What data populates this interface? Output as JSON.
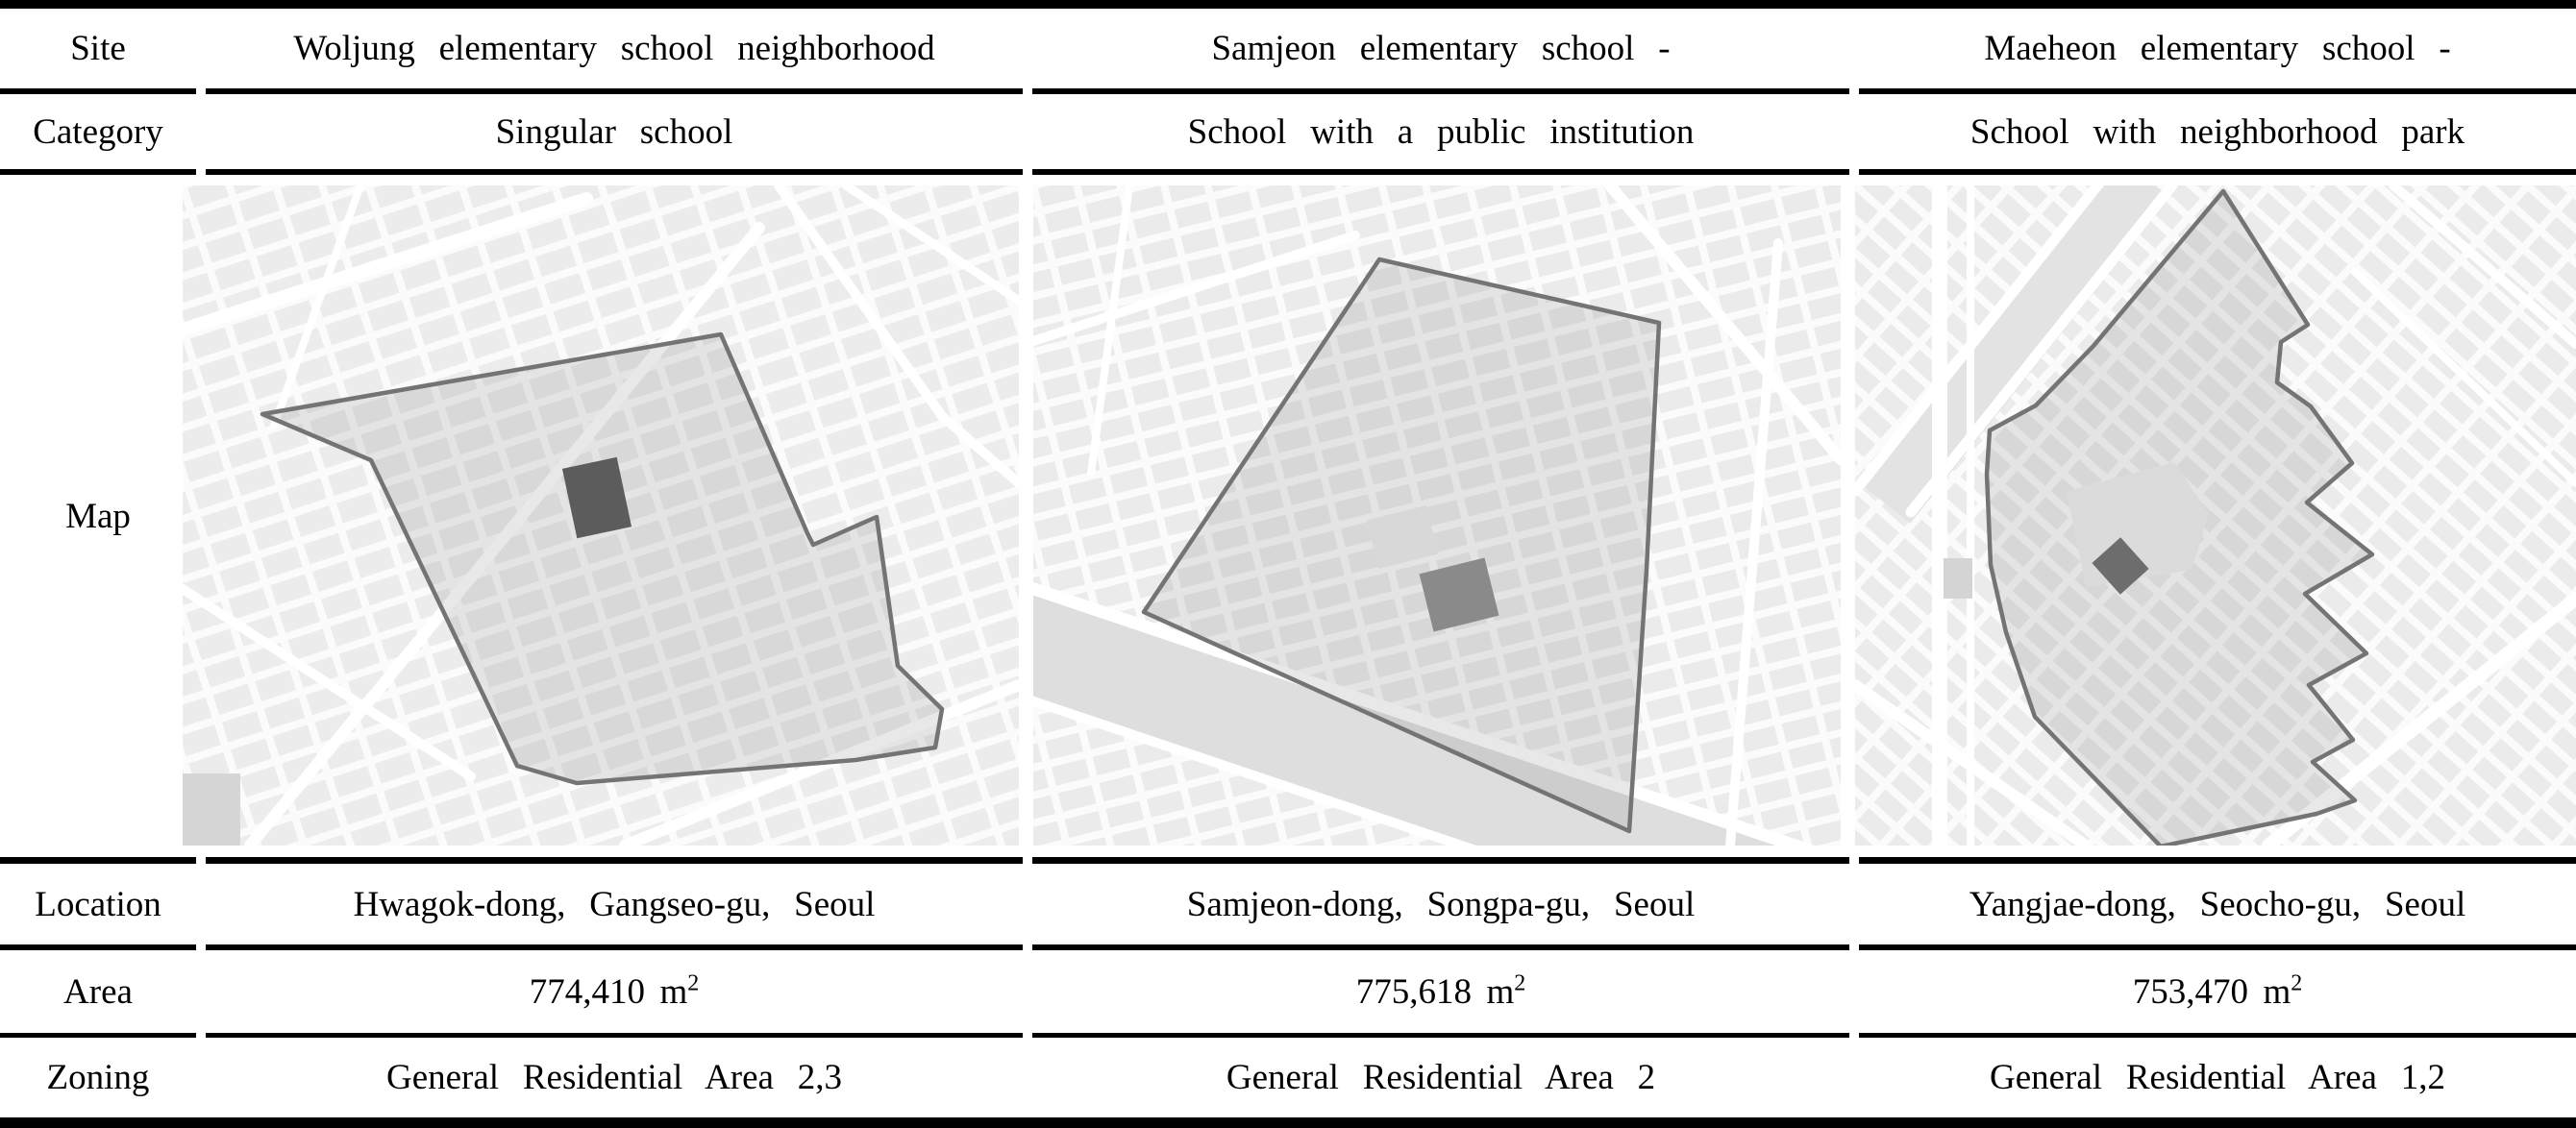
{
  "table": {
    "rows": {
      "site": {
        "label": "Site",
        "values": [
          "Woljung elementary school neighborhood",
          "Samjeon elementary school -",
          "Maeheon elementary school -"
        ]
      },
      "category": {
        "label": "Category",
        "values": [
          "Singular school",
          "School with a public institution",
          "School with neighborhood park"
        ]
      },
      "map": {
        "label": "Map",
        "images": [
          {
            "name": "woljung-site-map",
            "description": "street map with site boundary and school building"
          },
          {
            "name": "samjeon-site-map",
            "description": "street map with site boundary and school building"
          },
          {
            "name": "maeheon-site-map",
            "description": "street map with site boundary, park and school building"
          }
        ]
      },
      "location": {
        "label": "Location",
        "values": [
          "Hwagok-dong, Gangseo-gu, Seoul",
          "Samjeon-dong, Songpa-gu, Seoul",
          "Yangjae-dong, Seocho-gu, Seoul"
        ]
      },
      "area": {
        "label": "Area",
        "values": [
          "774,410",
          "775,618",
          "753,470"
        ],
        "unit": "m",
        "unit_exponent": "2"
      },
      "zoning": {
        "label": "Zoning",
        "values": [
          "General Residential Area 2,3",
          "General Residential Area 2",
          "General Residential Area 1,2"
        ]
      }
    }
  },
  "colors": {
    "rule": "#000000",
    "map_block": "#e8e8e8",
    "street": "#ffffff",
    "site_boundary": "#747474",
    "site_fill": "rgba(130,130,130,0.18)",
    "school_building_dark": "#5c5c5c",
    "school_building_mid": "#8a8a8a",
    "park": "#dbdbdb"
  }
}
